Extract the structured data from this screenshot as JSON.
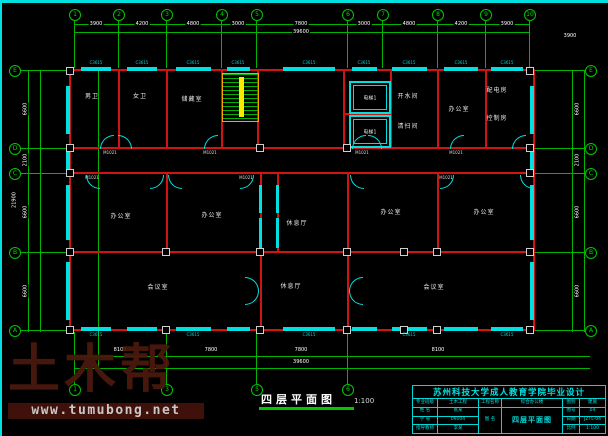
{
  "colors": {
    "axis_green": "#00b400",
    "wall_red": "#d01414",
    "fixture_cyan": "#00e0e0",
    "stair_yellow": "#ffe800",
    "dim_white": "#ffffff",
    "watermark_brown": "#4a190d",
    "url_bar_bg": "#40100a"
  },
  "watermark": {
    "logo": "土木帮",
    "url": "www.tumubong.net"
  },
  "plan_title": {
    "text": "四层平面图",
    "scale": "1:100"
  },
  "axes": {
    "top": [
      "1",
      "2",
      "3",
      "4",
      "5",
      "6",
      "7",
      "8",
      "9",
      "10"
    ],
    "bottom": [
      "1",
      "3",
      "5",
      "6"
    ],
    "left": [
      "E",
      "D",
      "C",
      "B",
      "A"
    ],
    "right": [
      "E",
      "D",
      "C",
      "B",
      "A"
    ]
  },
  "rooms": [
    "男卫",
    "女卫",
    "储藏室",
    "电梯1",
    "电梯1",
    "开水间",
    "清扫间",
    "办公室",
    "配电房",
    "控制房",
    "办公室",
    "办公室",
    "休息厅",
    "办公室",
    "办公室",
    "会议室",
    "休息厅",
    "会议室"
  ],
  "dims": {
    "top": [
      "3900",
      "4200",
      "4800",
      "3000",
      "7800",
      "3000",
      "4800",
      "4200",
      "3900"
    ],
    "top_total": "39600",
    "top_right": "3900",
    "bottom": [
      "8100",
      "7800",
      "7800",
      "8100"
    ],
    "bottom_total": "39600",
    "left": [
      "6600",
      "2100",
      "6600",
      "6600"
    ],
    "left_total": "21900",
    "right": [
      "6600",
      "2100",
      "6600",
      "6600"
    ],
    "window_tag": "C3615",
    "door_tag": "M1021"
  },
  "title_block": {
    "banner": "苏州科技大学成人教育学院毕业设计",
    "fields": {
      "major_label": "专业班级",
      "major_value": "土木工程",
      "name_label": "姓 名",
      "name_value": "张某",
      "id_label": "学 号",
      "id_value": "09104",
      "advisor_label": "指导教师",
      "advisor_value": "李某",
      "project_label": "工程名称",
      "project_value": "综合办公楼",
      "sheet_label": "图 名",
      "sheet_value": "四层平面图",
      "type_label": "图别",
      "type_value": "建施",
      "no_label": "图号",
      "no_value": "04",
      "date_label": "日期",
      "date_value": "JZTL-04",
      "scale_label": "比例",
      "scale_value": "1:100"
    }
  }
}
